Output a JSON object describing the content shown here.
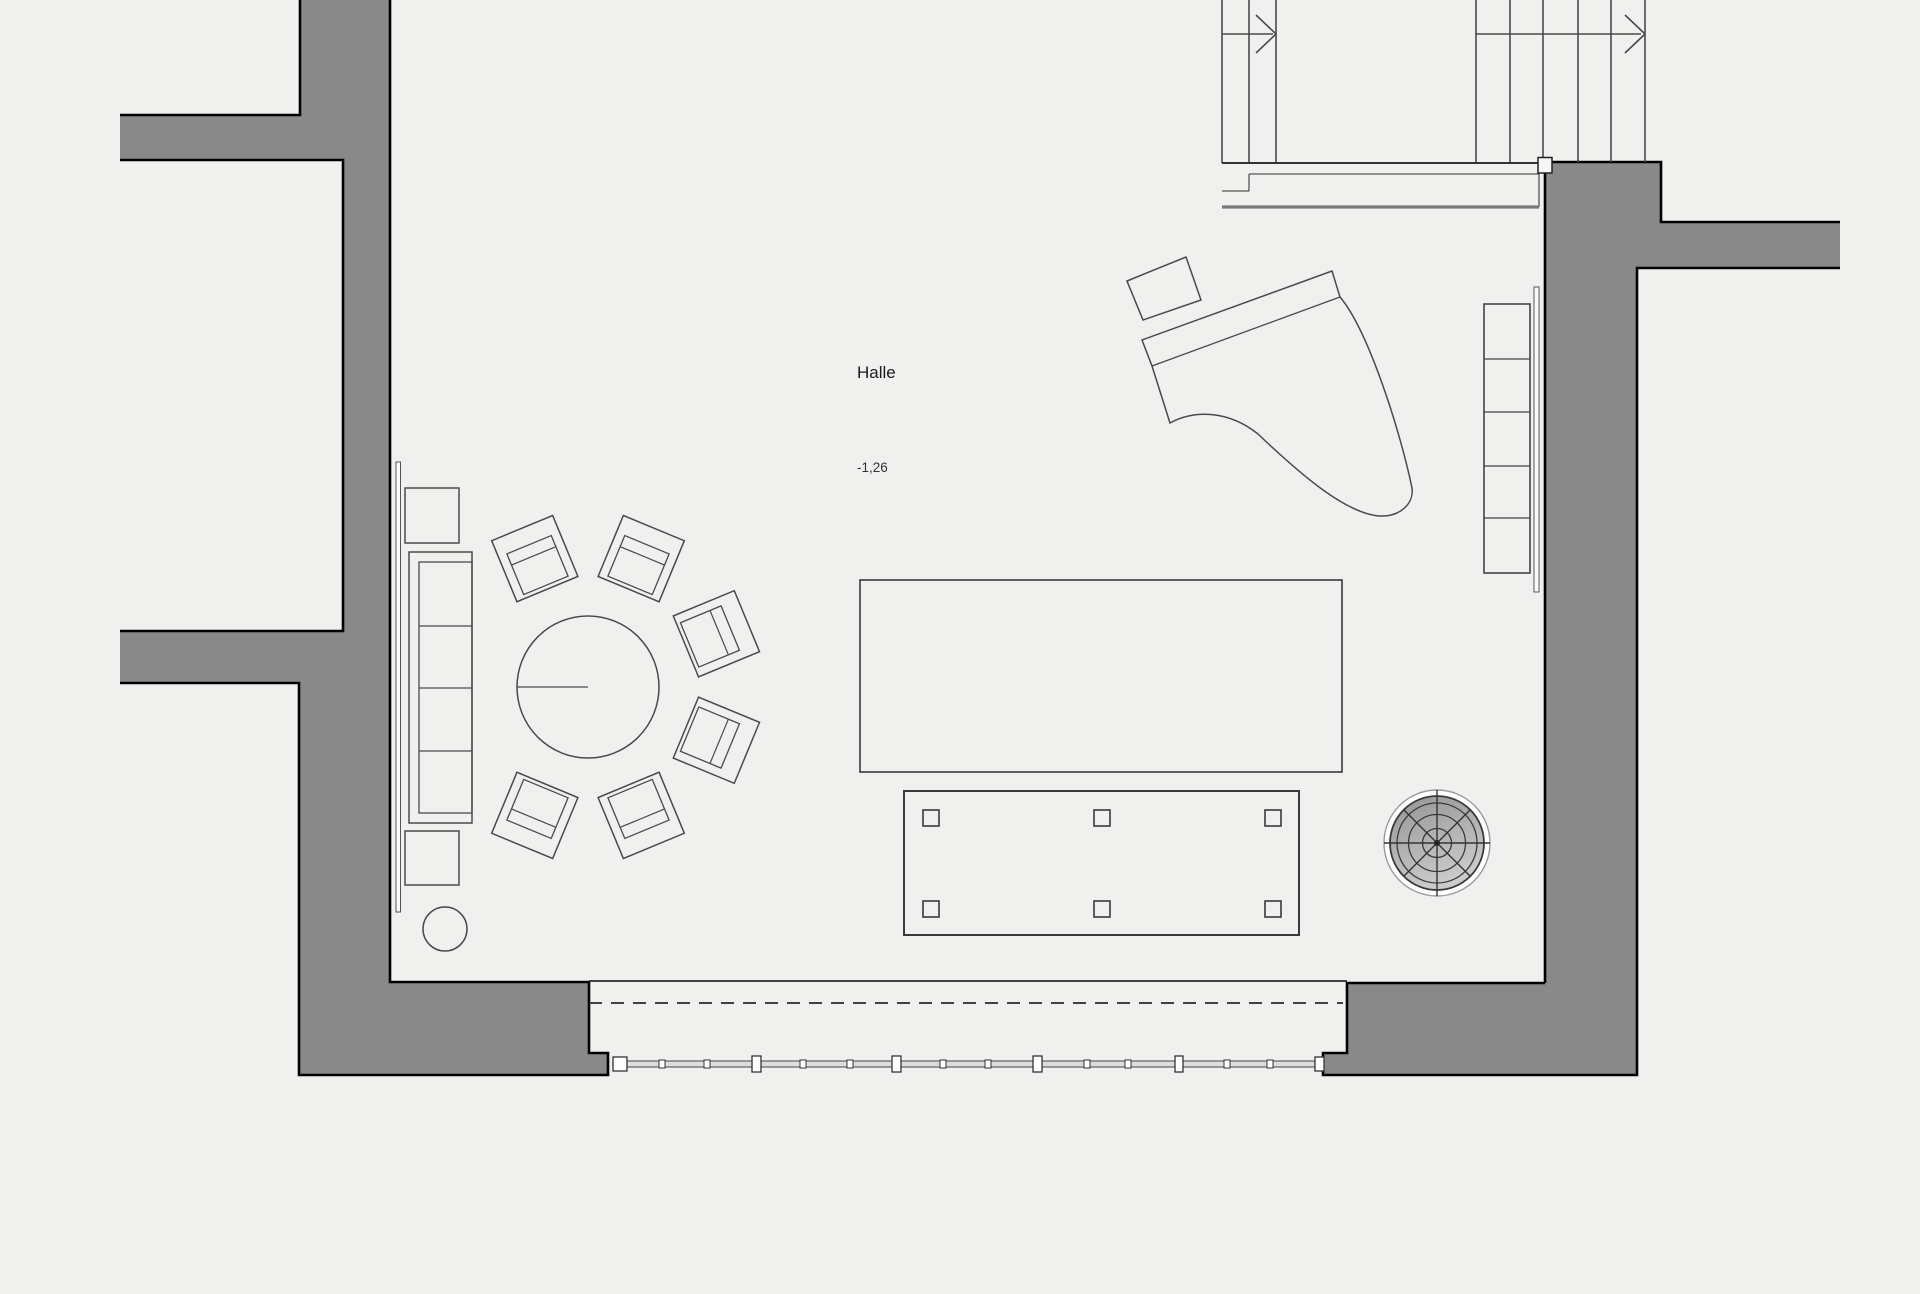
{
  "room": {
    "label": "Halle",
    "elevation": "-1,26"
  },
  "colors": {
    "background": "#f0f0ef",
    "wall_fill": "#898989",
    "wall_outline": "#000000",
    "furniture_line": "#4a4a4a",
    "thin_line": "#666666",
    "landing_edge": "#7a7a7a",
    "text": "#1a1a1a",
    "fan_dark": "#969696",
    "fan_light": "#c9c9c9",
    "glass_fill": "#dddddd",
    "post_fill": "#ffffff"
  }
}
